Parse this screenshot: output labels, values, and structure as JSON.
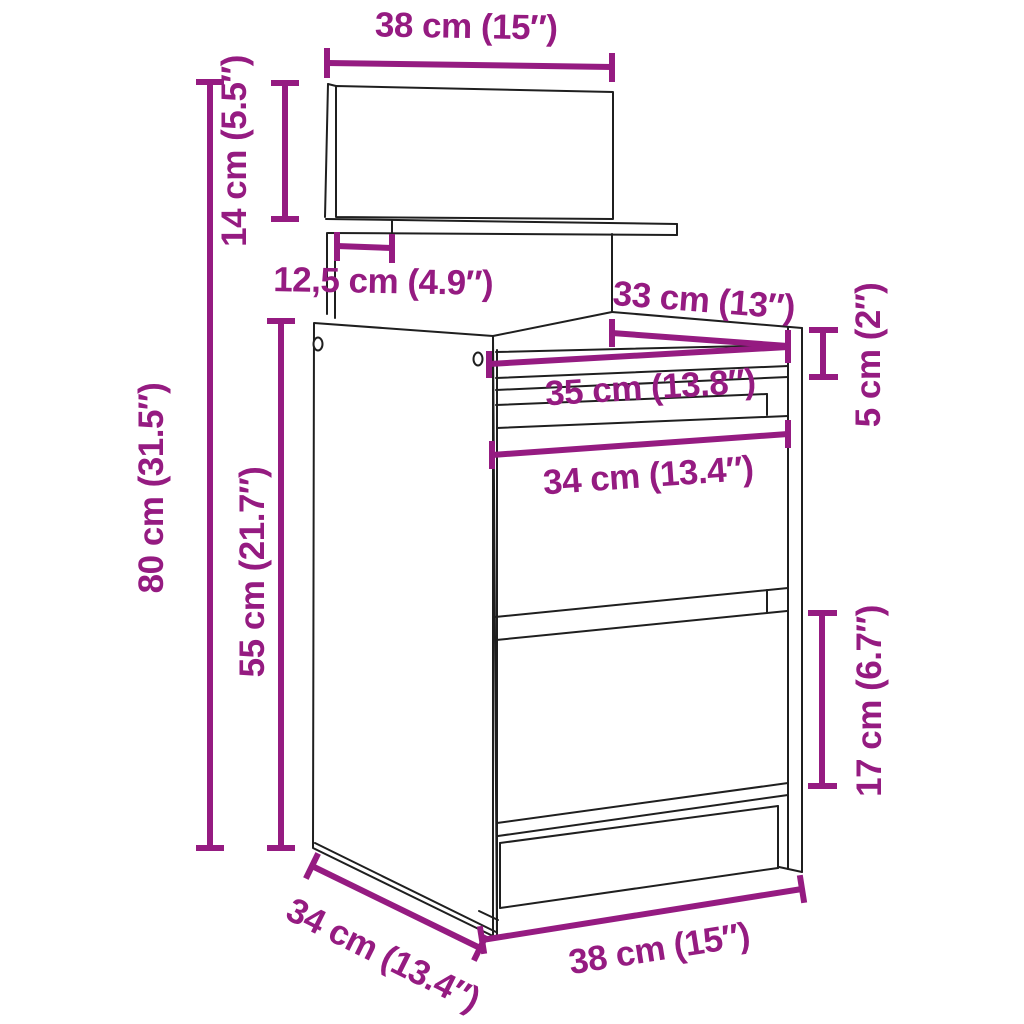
{
  "figure": {
    "type": "furniture-dimension-diagram",
    "subject": "bedside cabinet with two drawers and wall panel shelf"
  },
  "colors": {
    "dimension_accent": "#951b81",
    "outline": "#1f1f1f",
    "background": "#ffffff"
  },
  "dimensions": [
    {
      "id": "panel-width",
      "label": "38 cm (15″)",
      "cm": "38",
      "inches": "15",
      "orientation": "horizontal"
    },
    {
      "id": "panel-height",
      "label": "14 cm (5.5″)",
      "cm": "14",
      "inches": "5.5",
      "orientation": "vertical"
    },
    {
      "id": "shelf-depth",
      "label": "12,5 cm (4.9″)",
      "cm": "12,5",
      "inches": "4.9",
      "orientation": "horizontal"
    },
    {
      "id": "total-height",
      "label": "80 cm (31.5″)",
      "cm": "80",
      "inches": "31.5",
      "orientation": "vertical"
    },
    {
      "id": "cabinet-height",
      "label": "55 cm (21.7″)",
      "cm": "55",
      "inches": "21.7",
      "orientation": "vertical"
    },
    {
      "id": "top-depth",
      "label": "33 cm (13″)",
      "cm": "33",
      "inches": "13",
      "orientation": "horizontal"
    },
    {
      "id": "top-thickness",
      "label": "5 cm (2″)",
      "cm": "5",
      "inches": "2",
      "orientation": "vertical"
    },
    {
      "id": "inner-width",
      "label": "35 cm (13.8″)",
      "cm": "35",
      "inches": "13.8",
      "orientation": "horizontal"
    },
    {
      "id": "drawer-width",
      "label": "34 cm (13.4″)",
      "cm": "34",
      "inches": "13.4",
      "orientation": "horizontal"
    },
    {
      "id": "drawer-height",
      "label": "17 cm (6.7″)",
      "cm": "17",
      "inches": "6.7",
      "orientation": "vertical"
    },
    {
      "id": "cabinet-depth",
      "label": "34 cm (13.4″)",
      "cm": "34",
      "inches": "13.4",
      "orientation": "diagonal"
    },
    {
      "id": "base-width",
      "label": "38 cm (15″)",
      "cm": "38",
      "inches": "15",
      "orientation": "diagonal"
    }
  ]
}
